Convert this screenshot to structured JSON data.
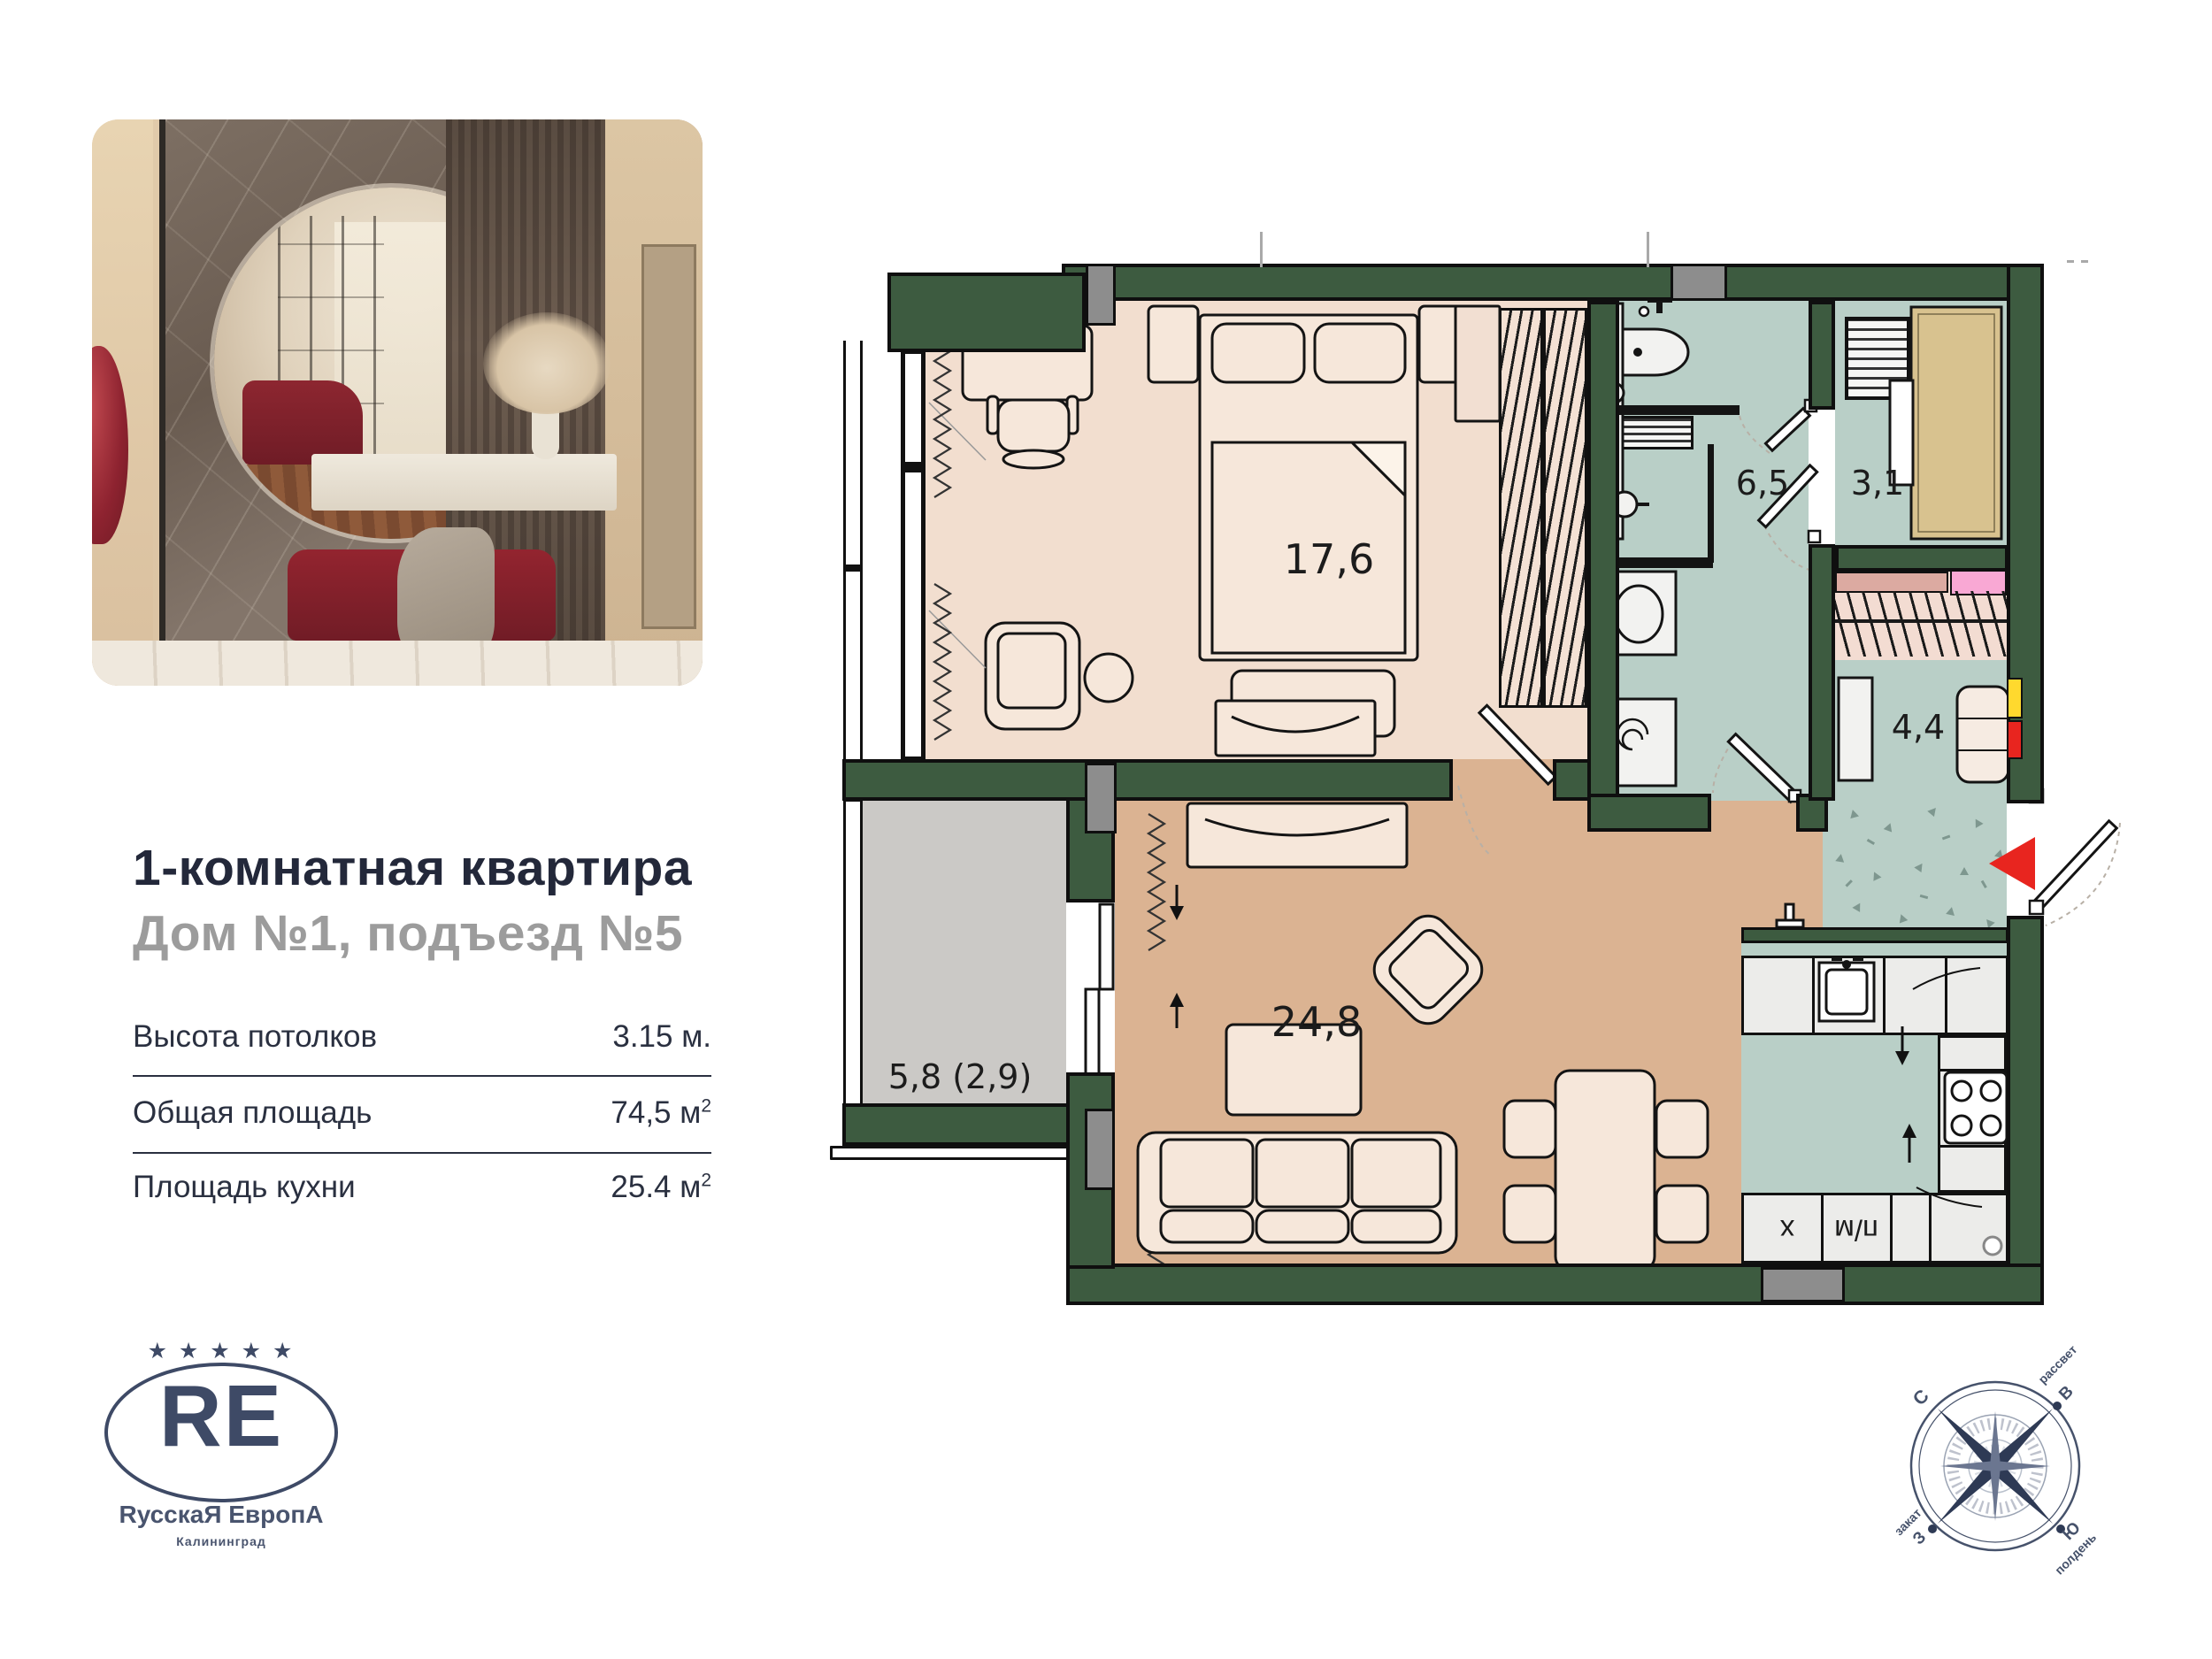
{
  "listing": {
    "title": "1-комнатная квартира",
    "subtitle": "Дом №1, подъезд №5"
  },
  "specs": {
    "rows": [
      {
        "label": "Высота потолков",
        "value": "3.15 м.",
        "sup": ""
      },
      {
        "label": "Общая площадь",
        "value": "74,5 м",
        "sup": "2"
      },
      {
        "label": "Площадь кухни",
        "value": "25.4 м",
        "sup": "2"
      }
    ]
  },
  "plan": {
    "rooms": {
      "bedroom": "17,6",
      "bathroom": "6,5",
      "storage": "3,1",
      "hall": "4,4",
      "living": "24,8",
      "balcony": "5,8 (2,9)"
    },
    "kitchen": {
      "fridge": "х",
      "dishwasher": "п/м"
    }
  },
  "logo": {
    "stars": "★ ★ ★ ★ ★",
    "monogram": "RE",
    "name": "RусскаЯ ЕвропА",
    "city": "Калининград"
  },
  "compass": {
    "north": "С",
    "east": "В",
    "west": "З",
    "south": "Ю",
    "dawn": "рассвет",
    "sunset": "закат",
    "noon": "полдень"
  },
  "colors": {
    "wall_green": "#3d5b40",
    "floor_bedroom": "#f2decf",
    "floor_living": "#dbb392",
    "floor_wet": "#b9cfc7",
    "floor_balcony": "#cbc9c6",
    "closet_tan": "#d8c28f",
    "marker_red": "#e8251f",
    "marker_yellow": "#ffd92e",
    "brand_navy": "#3e4a66"
  }
}
